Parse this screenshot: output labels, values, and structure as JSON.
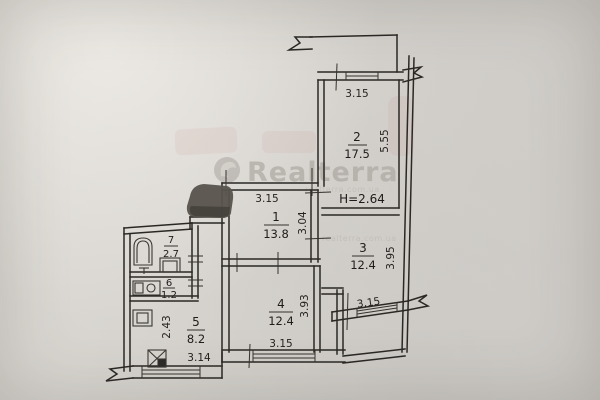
{
  "watermark": {
    "brand": "Realterra",
    "url": "realterra.com.ua"
  },
  "plan": {
    "height_label": "H=2.64",
    "rooms": {
      "r1": {
        "number": "1",
        "area": "13.8"
      },
      "r2": {
        "number": "2",
        "area": "17.5"
      },
      "r3": {
        "number": "3",
        "area": "12.4"
      },
      "r4": {
        "number": "4",
        "area": "12.4"
      },
      "r5": {
        "number": "5",
        "area": "8.2"
      },
      "r6": {
        "number": "6",
        "area": "1.2"
      },
      "r7": {
        "number": "7",
        "area": "2.7"
      }
    },
    "dims": {
      "top_balcony": "3.15",
      "room2_depth": "5.55",
      "room1_width": "3.15",
      "room1_depth": "3.04",
      "room3_depth": "3.95",
      "right_balcony": "3.15",
      "room4_depth": "3.93",
      "room4_width": "3.15",
      "kitchen_depth": "2.43",
      "kitchen_width": "3.14"
    }
  }
}
